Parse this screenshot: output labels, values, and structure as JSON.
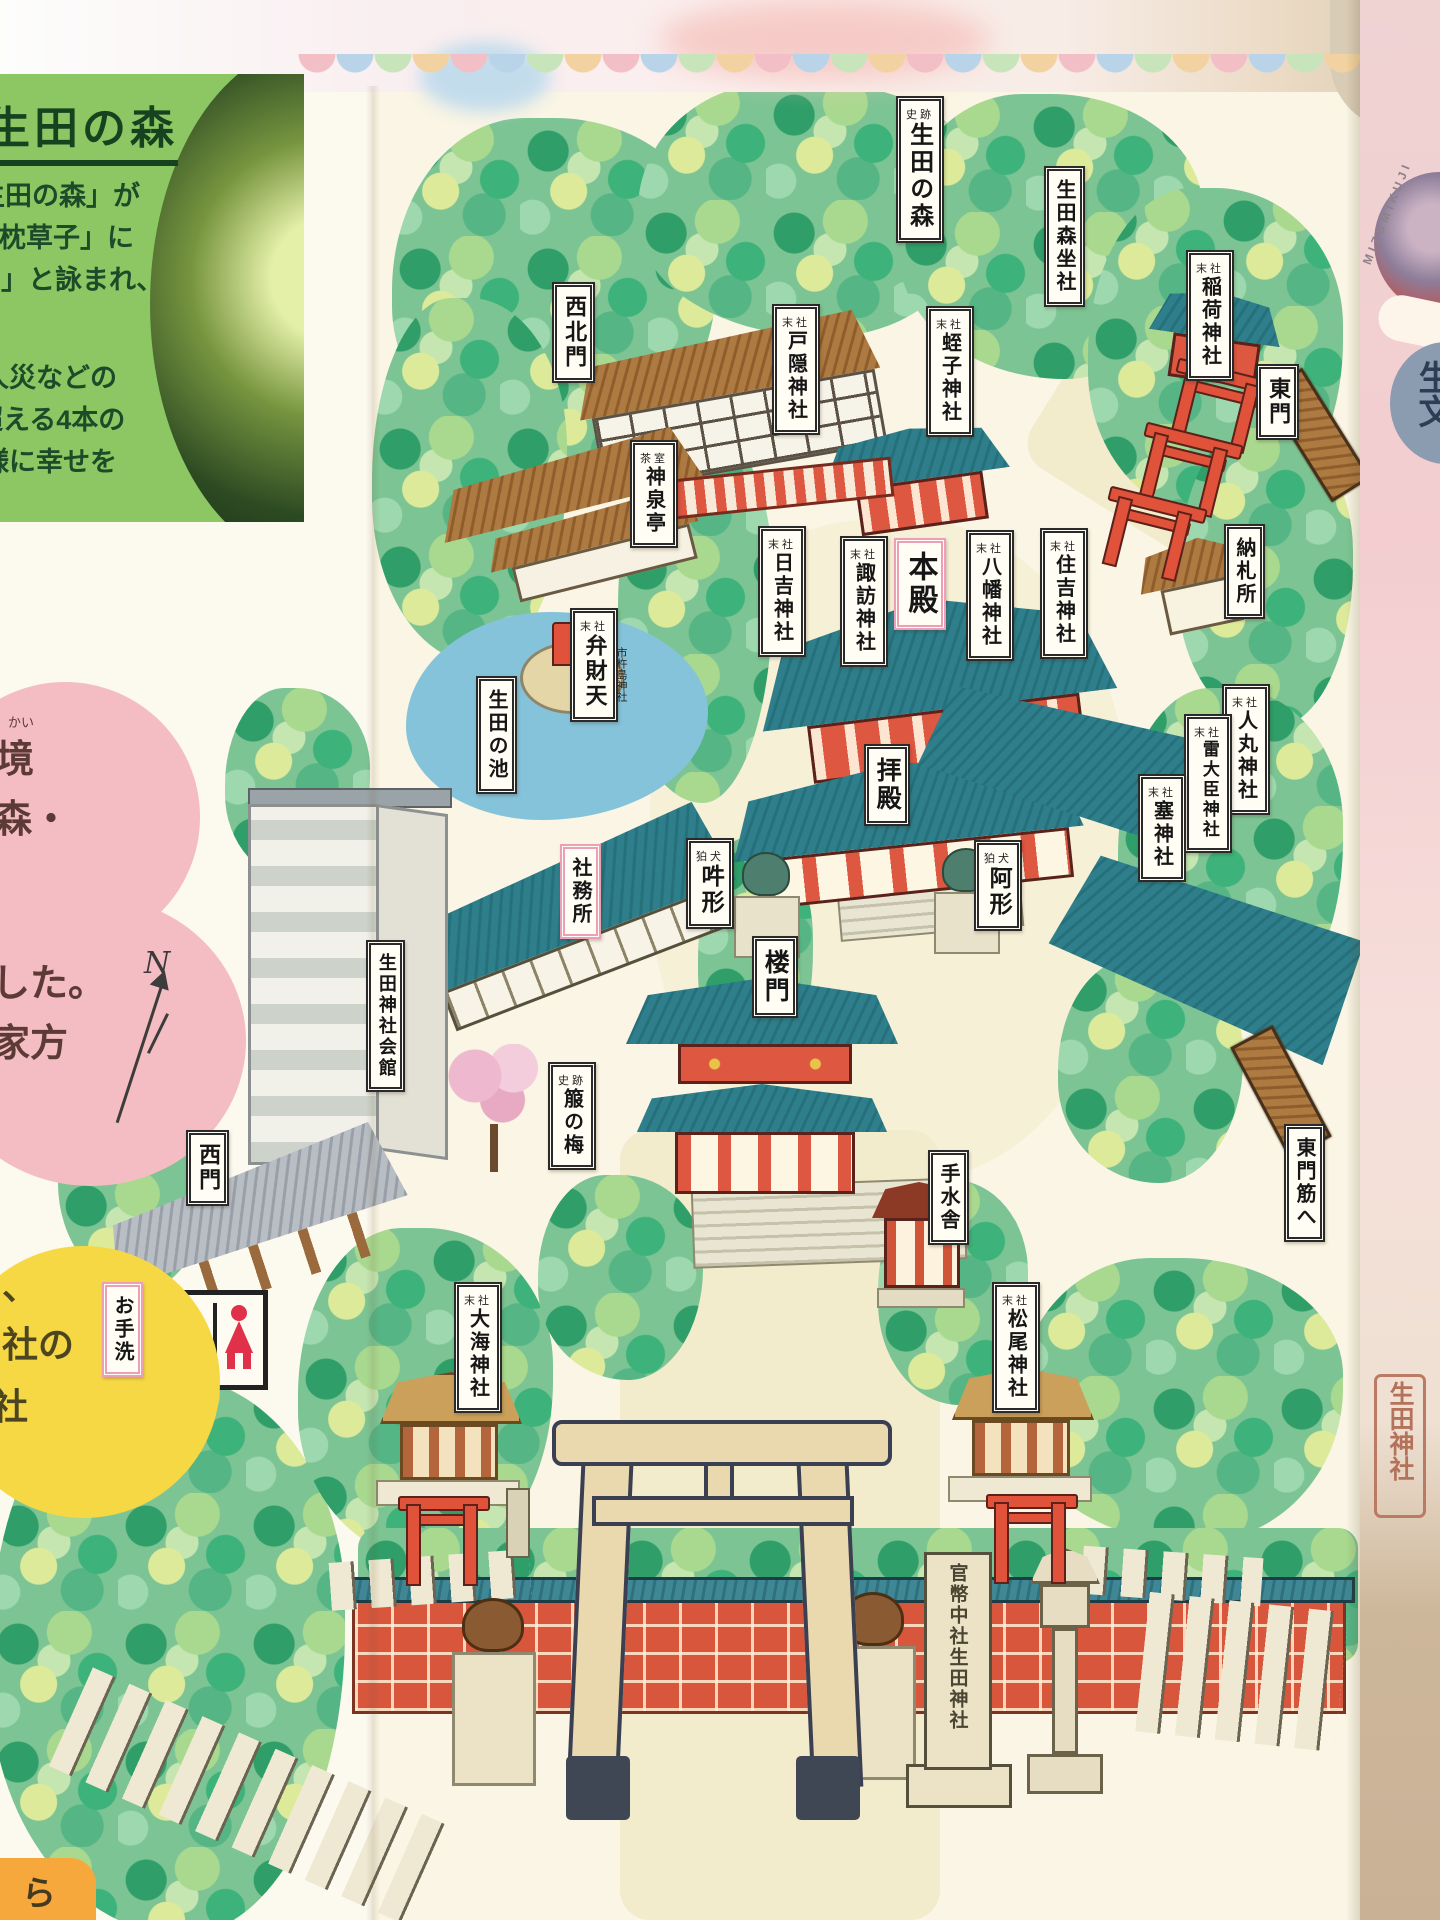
{
  "left_panel": {
    "title": "生田の森",
    "lines": [
      "生田の森」が",
      "「枕草子」に",
      "‥」と詠まれ、",
      "人災などの",
      "超える4本の",
      "様に幸せを"
    ]
  },
  "left_column": {
    "pink_note_top": {
      "furigana": "かい",
      "line1": "境",
      "line2": "森・"
    },
    "pink_note_bottom": {
      "line1": "した。",
      "line2": "家方"
    },
    "yellow_note": {
      "line1": "、",
      "line2": "社の",
      "line3": "社"
    },
    "compass": "N",
    "orange_fragment": "ら"
  },
  "map": {
    "labels": [
      {
        "prefix": "史跡",
        "text": "生田の森"
      },
      {
        "text": "生田森坐社"
      },
      {
        "prefix": "末社",
        "text": "稲荷神社"
      },
      {
        "text": "東門"
      },
      {
        "text": "西北門"
      },
      {
        "prefix": "末社",
        "text": "戸隠神社"
      },
      {
        "prefix": "末社",
        "text": "蛭子神社"
      },
      {
        "text": "納札所"
      },
      {
        "prefix": "茶室",
        "text": "神泉亭"
      },
      {
        "prefix": "末社",
        "text": "弁財天"
      },
      {
        "prefix": "末社",
        "text": "日吉神社"
      },
      {
        "prefix": "末社",
        "text": "諏訪神社"
      },
      {
        "text": "本殿"
      },
      {
        "prefix": "末社",
        "text": "八幡神社"
      },
      {
        "prefix": "末社",
        "text": "住吉神社"
      },
      {
        "text": "生田の池"
      },
      {
        "text": "拝殿"
      },
      {
        "prefix": "末社",
        "text": "人丸神社"
      },
      {
        "prefix": "末社",
        "text": "雷大臣神社"
      },
      {
        "prefix": "末社",
        "text": "塞神社"
      },
      {
        "prefix": "狛犬",
        "text": "吽形"
      },
      {
        "prefix": "狛犬",
        "text": "阿形"
      },
      {
        "text": "社務所"
      },
      {
        "text": "楼門"
      },
      {
        "text": "生田神社会館"
      },
      {
        "prefix": "史跡",
        "text": "箙の梅"
      },
      {
        "text": "手水舎"
      },
      {
        "text": "東門筋へ"
      },
      {
        "text": "西門"
      },
      {
        "text": "お手洗"
      },
      {
        "prefix": "末社",
        "text": "大海神社"
      },
      {
        "prefix": "末社",
        "text": "松尾神社"
      }
    ],
    "benzaiten_side": "市杵島神社",
    "pillar": "官幣中社生田神社"
  },
  "right_strip": {
    "arc_text": "MIZUMIKUJI",
    "circle_text": "生文",
    "stamp": "生田神社"
  },
  "palette": {
    "map_paper": "#faf5e4",
    "tree_dark": "#2f9e68",
    "tree_light": "#dcea9a",
    "roof_teal": "#2e7f8b",
    "vermillion": "#e0523a",
    "big_torii_tan": "#ead9ae",
    "panel_green": "#8cc763",
    "note_pink": "#f4bcc3",
    "note_yellow": "#f6d845",
    "highlight_pink": "#ec9fb6"
  }
}
